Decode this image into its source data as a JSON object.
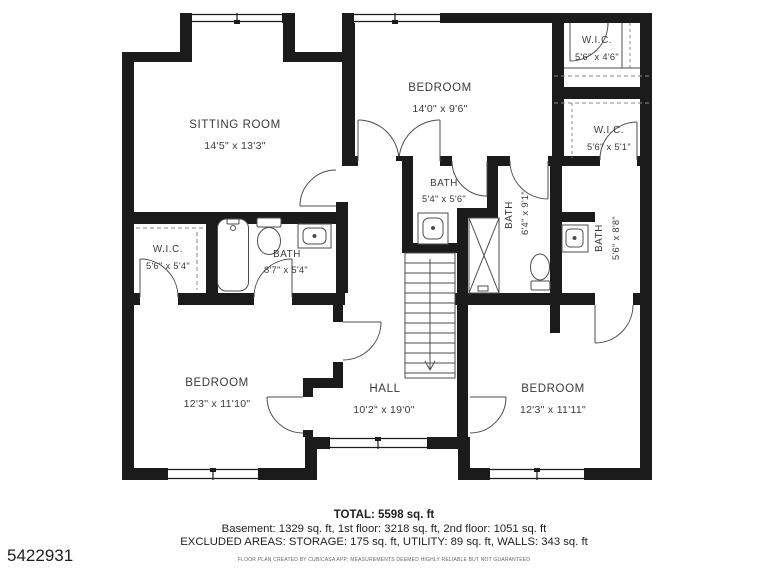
{
  "palette": {
    "wall_color": "#1b1b1b",
    "line_color": "#4d4d4d",
    "dash_color": "#8a8a8a",
    "text_color": "#3a3a3a",
    "background": "#ffffff"
  },
  "rooms": [
    {
      "id": "sitting-room",
      "name": "SITTING ROOM",
      "dims": "14'5\" x 13'3\""
    },
    {
      "id": "bedroom-top",
      "name": "BEDROOM",
      "dims": "14'0\" x 9'6\""
    },
    {
      "id": "wic-top-right",
      "name": "W.I.C.",
      "dims": "5'6\" x 4'6\""
    },
    {
      "id": "wic-mid-right",
      "name": "W.I.C.",
      "dims": "5'6\" x 5'1\""
    },
    {
      "id": "bath-center",
      "name": "BATH",
      "dims": "5'4\" x 5'6\""
    },
    {
      "id": "bath-middle",
      "name": "BATH",
      "dims": "6'4\" x 9'1\""
    },
    {
      "id": "bath-right",
      "name": "BATH",
      "dims": "5'6\" x 8'8\""
    },
    {
      "id": "wic-left",
      "name": "W.I.C.",
      "dims": "5'6\" x 5'4\""
    },
    {
      "id": "bath-left",
      "name": "BATH",
      "dims": "8'7\" x 5'4\""
    },
    {
      "id": "bedroom-left",
      "name": "BEDROOM",
      "dims": "12'3\" x 11'10\""
    },
    {
      "id": "hall",
      "name": "HALL",
      "dims": "10'2\" x 19'0\""
    },
    {
      "id": "bedroom-right",
      "name": "BEDROOM",
      "dims": "12'3\" x 11'11\""
    }
  ],
  "summary": {
    "total": "TOTAL: 5598 sq. ft",
    "floors": "Basement: 1329 sq. ft, 1st floor: 3218 sq. ft, 2nd floor: 1051 sq. ft",
    "excluded": "EXCLUDED AREAS: STORAGE: 175 sq. ft, UTILITY: 89 sq. ft, WALLS: 343 sq. ft",
    "disclaimer": "FLOOR PLAN CREATED BY CUBICASA APP; MEASUREMENTS DEEMED HIGHLY RELIABLE BUT NOT GUARANTEED"
  },
  "plan_id": "5422931"
}
